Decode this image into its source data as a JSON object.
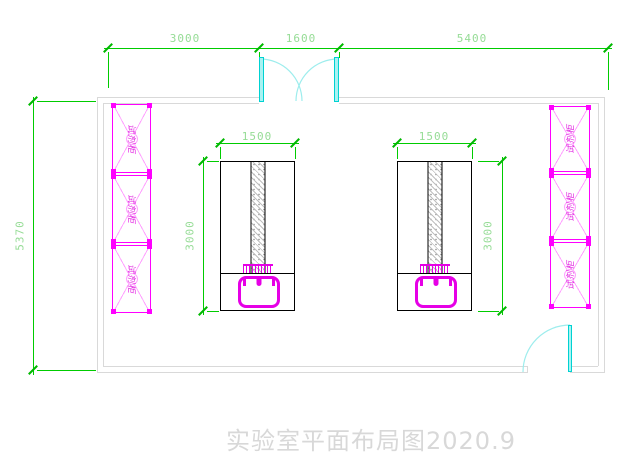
{
  "drawing": {
    "title": "实验室平面布局图2020.9"
  },
  "dimensions": {
    "top_segments": [
      "3000",
      "1600",
      "5400"
    ],
    "room_depth": "5370",
    "bench_left": {
      "width": "1500",
      "depth": "3000"
    },
    "bench_right": {
      "width": "1500",
      "depth": "3000"
    }
  },
  "cabinet": {
    "label": "试剂柜"
  },
  "colors": {
    "dimension_line": "#00cc00",
    "dimension_text": "#96dc96",
    "wall": "#d9d9d9",
    "door_panel": "#00d2d2",
    "door_arc": "#9deded",
    "cabinet": "#ff00ff",
    "cabinet_detail": "#ffa2ff",
    "bench_outline": "#000000",
    "sink": "#e600e6",
    "title_text": "#d8d8d8"
  }
}
